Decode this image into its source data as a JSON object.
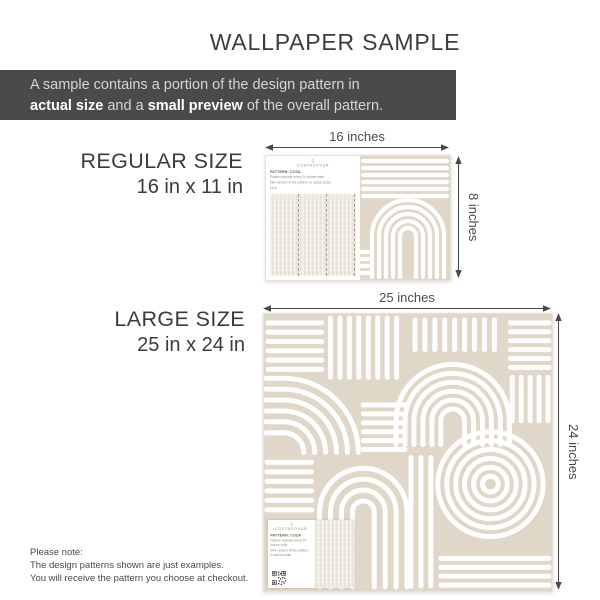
{
  "title": "WALLPAPER SAMPLE",
  "banner": {
    "line1": "A sample contains a portion of the design pattern in",
    "bold1": "actual size",
    "mid": " and a ",
    "bold2": "small preview",
    "tail": " of the overall pattern."
  },
  "regular": {
    "heading": "REGULAR SIZE",
    "size": "16 in x 11 in",
    "width_label": "16 inches",
    "height_label": "8 inches"
  },
  "large": {
    "heading": "LARGE SIZE",
    "size": "25 in x 24 in",
    "width_label": "25 inches",
    "height_label": "24 inches"
  },
  "sample_card": {
    "brand": "COSTACOVER",
    "pattern_label": "PATTERN: COZA",
    "line1": "Pattern repeats every 24 inches wide",
    "line2": "Mini version of the pattern, in actual scale",
    "mini_arrow_label": "24 in"
  },
  "note": {
    "line1": "Please note:",
    "line2": "The design patterns shown are just examples.",
    "line3": "You will receive the pattern you choose at checkout."
  },
  "colors": {
    "banner_bg": "#4a4a4a",
    "pattern_beige": "#e0d7c8",
    "pattern_stroke": "#ffffff",
    "text_dark": "#3c3c3c",
    "dimension": "#4a4a4a"
  }
}
